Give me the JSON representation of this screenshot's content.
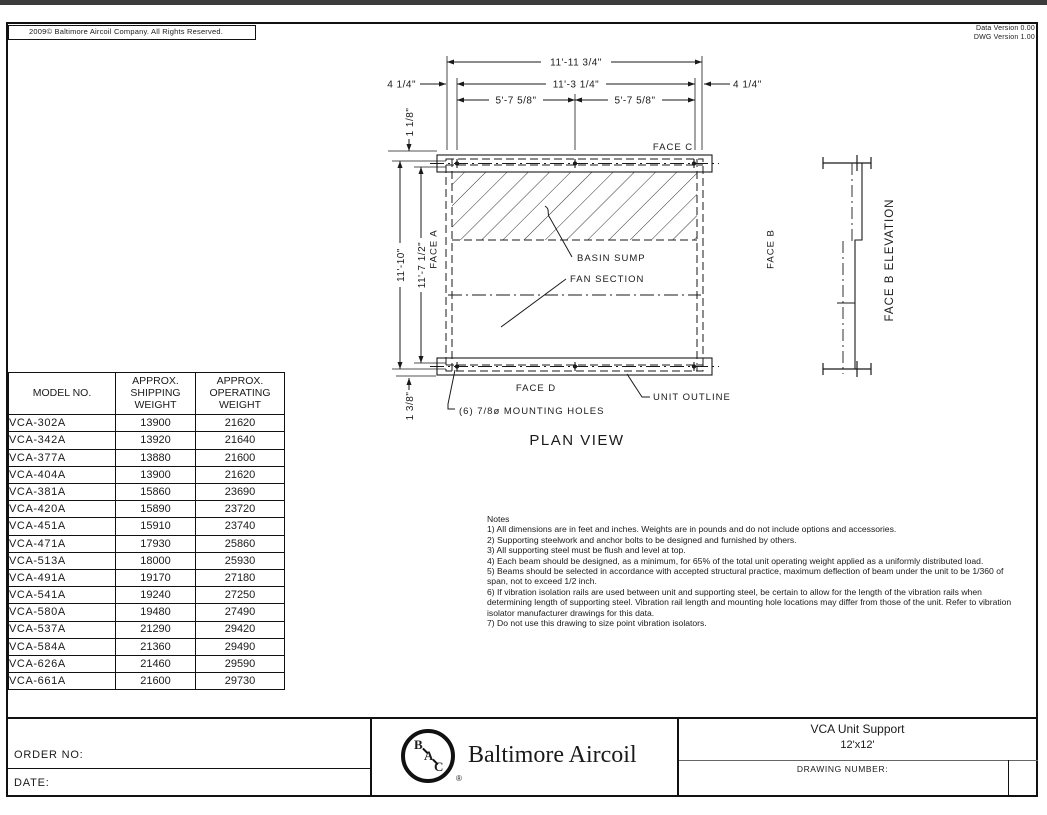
{
  "meta": {
    "copyright": "2009© Baltimore Aircoil Company. All Rights Reserved.",
    "data_version": "Data Version 0.00",
    "dwg_version": "DWG Version 1.00"
  },
  "plan": {
    "title": "PLAN VIEW",
    "dims": {
      "overall_w": "11'-11 3/4\"",
      "holes_w": "11'-3 1/4\"",
      "half_w_left": "5'-7 5/8\"",
      "half_w_right": "5'-7 5/8\"",
      "edge_left": "4 1/4\"",
      "edge_right": "4 1/4\"",
      "top_inset": "1 1/8\"",
      "overall_h": "11'-10\"",
      "holes_h": "11'-7 1/2\"",
      "bottom_inset": "1 3/8\""
    },
    "faces": {
      "a": "FACE A",
      "b": "FACE B",
      "c": "FACE C",
      "d": "FACE D"
    },
    "labels": {
      "basin_sump": "BASIN SUMP",
      "fan_section": "FAN SECTION",
      "unit_outline": "UNIT OUTLINE",
      "mounting_holes": "(6) 7/8ø MOUNTING HOLES"
    }
  },
  "elevation": {
    "title": "FACE B ELEVATION"
  },
  "weights_table": {
    "headers": [
      "MODEL NO.",
      "APPROX. SHIPPING WEIGHT",
      "APPROX. OPERATING WEIGHT"
    ],
    "rows": [
      {
        "model": "VCA-302A",
        "shipping": "13900",
        "operating": "21620"
      },
      {
        "model": "VCA-342A",
        "shipping": "13920",
        "operating": "21640"
      },
      {
        "model": "VCA-377A",
        "shipping": "13880",
        "operating": "21600"
      },
      {
        "model": "VCA-404A",
        "shipping": "13900",
        "operating": "21620"
      },
      {
        "model": "VCA-381A",
        "shipping": "15860",
        "operating": "23690"
      },
      {
        "model": "VCA-420A",
        "shipping": "15890",
        "operating": "23720"
      },
      {
        "model": "VCA-451A",
        "shipping": "15910",
        "operating": "23740"
      },
      {
        "model": "VCA-471A",
        "shipping": "17930",
        "operating": "25860"
      },
      {
        "model": "VCA-513A",
        "shipping": "18000",
        "operating": "25930"
      },
      {
        "model": "VCA-491A",
        "shipping": "19170",
        "operating": "27180"
      },
      {
        "model": "VCA-541A",
        "shipping": "19240",
        "operating": "27250"
      },
      {
        "model": "VCA-580A",
        "shipping": "19480",
        "operating": "27490"
      },
      {
        "model": "VCA-537A",
        "shipping": "21290",
        "operating": "29420"
      },
      {
        "model": "VCA-584A",
        "shipping": "21360",
        "operating": "29490"
      },
      {
        "model": "VCA-626A",
        "shipping": "21460",
        "operating": "29590"
      },
      {
        "model": "VCA-661A",
        "shipping": "21600",
        "operating": "29730"
      }
    ]
  },
  "notes": {
    "title": "Notes",
    "items": [
      "1) All dimensions are in feet and inches. Weights are in pounds and do not include options and accessories.",
      "2) Supporting steelwork and anchor bolts to be designed and furnished by others.",
      "3) All supporting steel must be flush and level at top.",
      "4) Each beam should be designed, as a minimum, for 65% of the total unit operating weight applied as a uniformly distributed load.",
      "5) Beams should be selected in accordance with accepted structural practice, maximum deflection of beam under the unit to be 1/360 of span, not to exceed 1/2 inch.",
      "6) If vibration isolation rails are used between unit and supporting steel, be certain to allow for the length of the vibration rails when determining length of supporting steel. Vibration rail length and mounting hole locations may differ from those of the unit. Refer to vibration isolator manufacturer drawings for this data.",
      "7) Do not use this drawing to size point vibration isolators."
    ]
  },
  "titleblock": {
    "order_label": "ORDER NO:",
    "date_label": "DATE:",
    "company": "Baltimore Aircoil",
    "logo_letters": [
      "B",
      "A",
      "C"
    ],
    "registered": "®",
    "product": "VCA Unit Support",
    "size": "12'x12'",
    "drawing_number_label": "DRAWING NUMBER:"
  }
}
